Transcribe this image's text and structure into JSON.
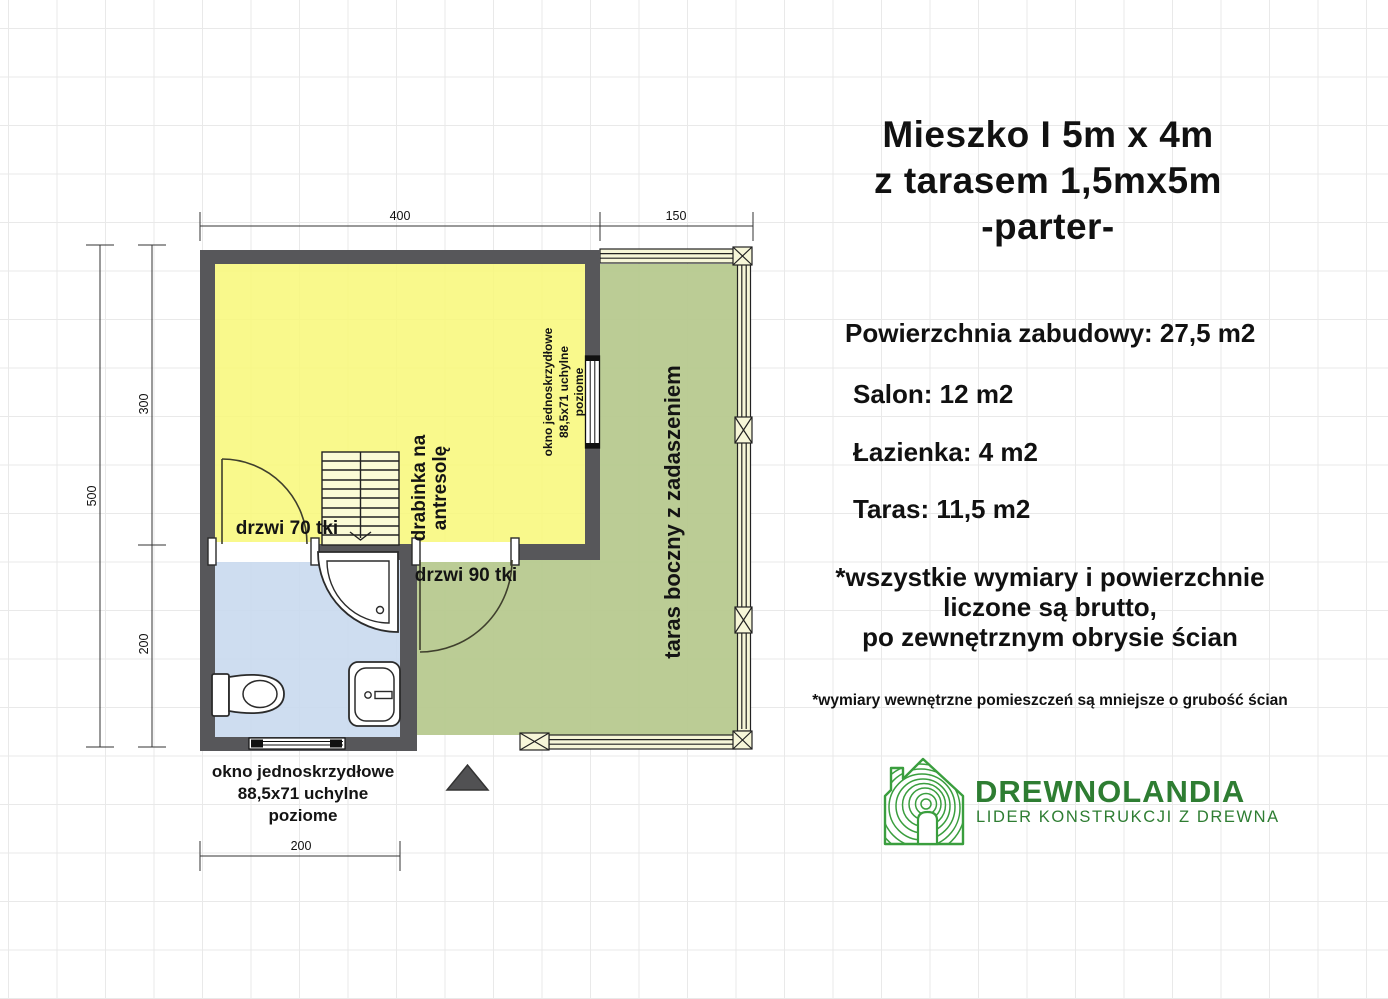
{
  "header": {
    "title_line1": "Mieszko I 5m x 4m",
    "title_line2": "z tarasem 1,5mx5m",
    "title_line3": "-parter-"
  },
  "specs": {
    "built_area": "Powierzchnia zabudowy: 27,5 m2",
    "salon": "Salon: 12 m2",
    "bathroom": "Łazienka: 4 m2",
    "terrace": "Taras: 11,5 m2"
  },
  "notes": {
    "gross_line1": "*wszystkie wymiary i powierzchnie",
    "gross_line2": "liczone są brutto,",
    "gross_line3": "po zewnętrznym obrysie ścian",
    "internal": "*wymiary wewnętrzne pomieszczeń są mniejsze o grubość ścian"
  },
  "logo": {
    "name": "DREWNOLANDIA",
    "tagline": "LIDER KONSTRUKCJI Z DREWNA",
    "text_color": "#2e7d32",
    "icon_color": "#3a9e3e"
  },
  "plan": {
    "dims": {
      "top_main": "400",
      "top_terrace": "150",
      "left_total": "500",
      "left_upper": "300",
      "left_lower": "200",
      "bottom": "200"
    },
    "labels": {
      "door70": "drzwi 70 tki",
      "door90": "drzwi 90 tki",
      "ladder1": "drabinka na",
      "ladder2": "antresolę",
      "win_r1": "okno jednoskrzydłowe",
      "win_r2": "88,5x71 uchylne",
      "win_r3": "poziome",
      "terrace": "taras boczny z zadaszeniem",
      "win_b1": "okno jednoskrzydłowe",
      "win_b2": "88,5x71 uchylne",
      "win_b3": "poziome"
    },
    "colors": {
      "wall": "#57575a",
      "salon": "#f8f878",
      "bathroom": "#c9d9ee",
      "terrace": "#b7c98f",
      "beam": "#f6f6d8"
    }
  }
}
